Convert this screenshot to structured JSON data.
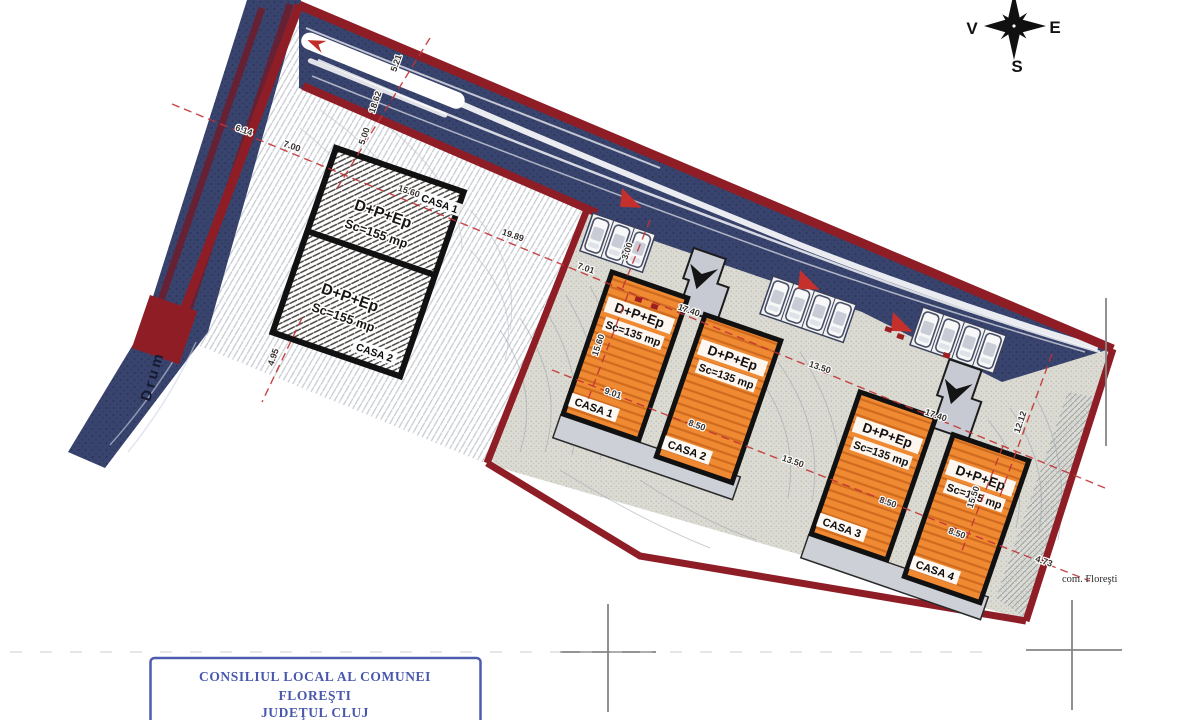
{
  "compass": {
    "west": "V",
    "east": "E",
    "south": "S"
  },
  "road_label": "Drum",
  "area_label": "com. Floreşti",
  "stamp": {
    "line1": "CONSILIUL LOCAL AL COMUNEI",
    "line2": "FLOREŞTI",
    "line3": "JUDEŢUL CLUJ"
  },
  "duplex": {
    "casa1": {
      "name": "CASA 1",
      "regime": "D+P+Ep",
      "area": "Sc=155 mp"
    },
    "casa2": {
      "name": "CASA 2",
      "regime": "D+P+Ep",
      "area": "Sc=155 mp"
    }
  },
  "houses": [
    {
      "name": "CASA 1",
      "regime": "D+P+Ep",
      "area": "Sc=135 mp"
    },
    {
      "name": "CASA 2",
      "regime": "D+P+Ep",
      "area": "Sc=135 mp"
    },
    {
      "name": "CASA 3",
      "regime": "D+P+Ep",
      "area": "Sc=135 mp"
    },
    {
      "name": "CASA 4",
      "regime": "D+P+Ep",
      "area": "Sc=135 mp"
    }
  ],
  "dims": [
    "6.14",
    "7.00",
    "5.21",
    "18.62",
    "5.00",
    "15.60",
    "19.89",
    "7.01",
    "3.00",
    "17.40",
    "15.60",
    "9.01",
    "8.50",
    "13.50",
    "13.50",
    "17.40",
    "8.50",
    "8.50",
    "15.50",
    "12.12",
    "4.73",
    "4.95"
  ],
  "colors": {
    "boundary": "#8e1d26",
    "road": "#39446e",
    "house_orange": "#ef8a33",
    "dim_red": "#c23335",
    "stamp_blue": "#3a4aa6"
  }
}
